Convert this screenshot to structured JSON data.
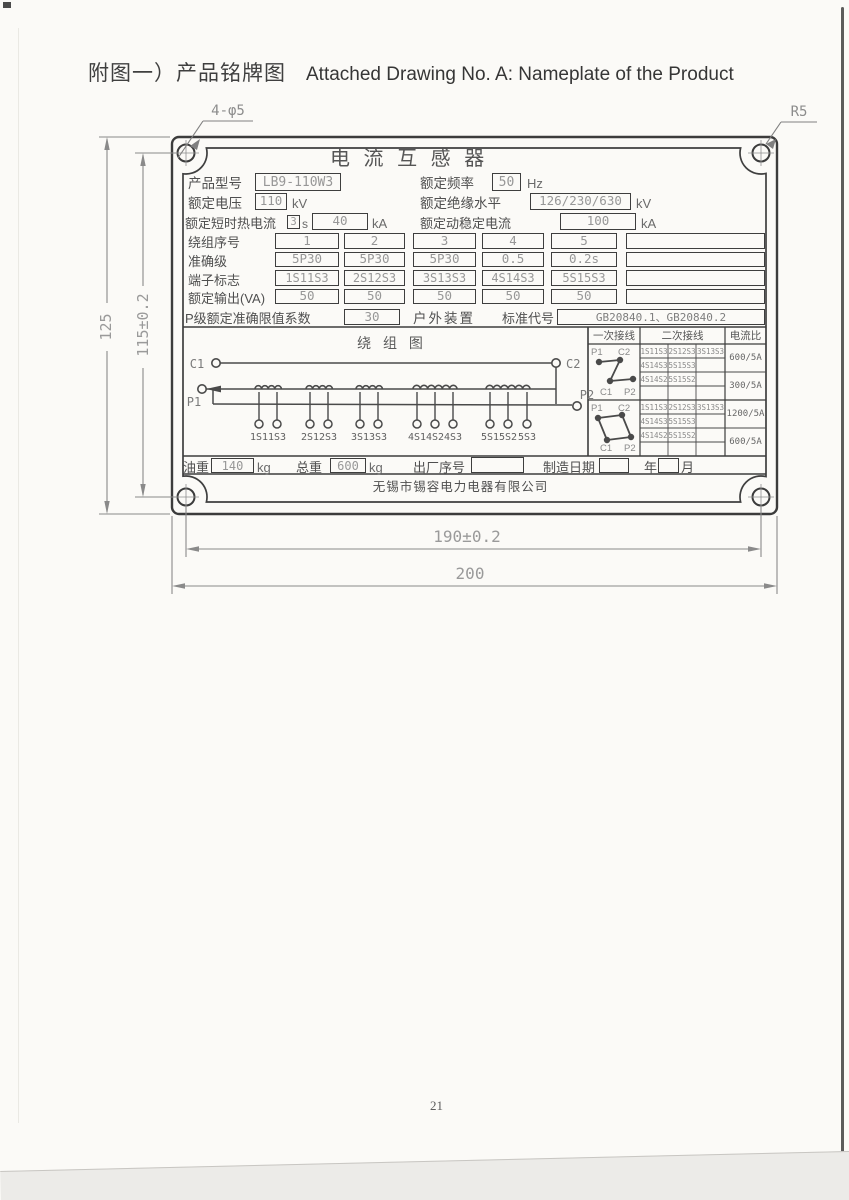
{
  "page": {
    "title_zh": "附图一）产品铭牌图",
    "title_en": "Attached Drawing No. A: Nameplate of the Product",
    "page_number": "21"
  },
  "dims": {
    "holes": "4-φ5",
    "radius": "R5",
    "h_outer": "125",
    "h_holes": "115±0.2",
    "w_holes": "190±0.2",
    "w_outer": "200"
  },
  "plate": {
    "title": "电 流 互 感 器",
    "model_label": "产品型号",
    "model": "LB9-110W3",
    "freq_label": "额定频率",
    "freq": "50",
    "freq_unit": "Hz",
    "volt_label": "额定电压",
    "volt": "110",
    "volt_unit": "kV",
    "insul_label": "额定绝缘水平",
    "insul": "126/230/630",
    "insul_unit": "kV",
    "thermal_label": "额定短时热电流",
    "thermal_time": "3",
    "thermal_time_unit": "s",
    "thermal": "40",
    "thermal_unit": "kA",
    "dynamic_label": "额定动稳定电流",
    "dynamic": "100",
    "dynamic_unit": "kA",
    "rows": [
      {
        "label": "绕组序号",
        "values": [
          "1",
          "2",
          "3",
          "4",
          "5",
          ""
        ]
      },
      {
        "label": "准确级",
        "values": [
          "5P30",
          "5P30",
          "5P30",
          "0.5",
          "0.2s",
          ""
        ]
      },
      {
        "label": "端子标志",
        "values": [
          "1S11S3",
          "2S12S3",
          "3S13S3",
          "4S14S3",
          "5S15S3",
          ""
        ]
      },
      {
        "label": "额定输出(VA)",
        "values": [
          "50",
          "50",
          "50",
          "50",
          "50",
          ""
        ]
      }
    ],
    "alf_label": "P级额定准确限值系数",
    "alf": "30",
    "outdoor": "户外装置",
    "std_label": "标准代号",
    "std": "GB20840.1、GB20840.2",
    "diagram": {
      "title": "绕 组 图",
      "c1": "C1",
      "c2": "C2",
      "p1": "P1",
      "p2": "P2",
      "terminals": [
        "1S1",
        "1S3",
        "2S1",
        "2S3",
        "3S1",
        "3S3",
        "4S1",
        "4S2",
        "4S3",
        "5S1",
        "5S2",
        "5S3"
      ]
    },
    "conn": {
      "h_primary": "一次接线",
      "h_secondary": "二次接线",
      "h_ratio": "电流比",
      "groups": [
        {
          "p1": "P1",
          "c2": "C2",
          "c1": "C1",
          "p2": "P2",
          "cells": [
            [
              "1S11S3",
              "2S12S3",
              "3S13S3"
            ],
            [
              "4S14S3",
              "5S15S3",
              ""
            ],
            [
              "4S14S2",
              "5S15S2",
              ""
            ],
            [
              "",
              "",
              ""
            ]
          ],
          "ratios": [
            "600/5A",
            "300/5A"
          ]
        },
        {
          "p1": "P1",
          "c2": "C2",
          "c1": "C1",
          "p2": "P2",
          "cells": [
            [
              "1S11S3",
              "2S12S3",
              "3S13S3"
            ],
            [
              "4S14S3",
              "5S15S3",
              ""
            ],
            [
              "4S14S2",
              "5S15S2",
              ""
            ],
            [
              "",
              "",
              ""
            ]
          ],
          "ratios": [
            "1200/5A",
            "600/5A"
          ]
        }
      ]
    },
    "oil_label": "油重",
    "oil": "140",
    "oil_unit": "kg",
    "weight_label": "总重",
    "weight": "600",
    "weight_unit": "kg",
    "serial_label": "出厂序号",
    "serial": "",
    "date_label": "制造日期",
    "year": "",
    "year_label": "年",
    "month": "",
    "month_label": "月",
    "company": "无锡市锡容电力电器有限公司"
  }
}
